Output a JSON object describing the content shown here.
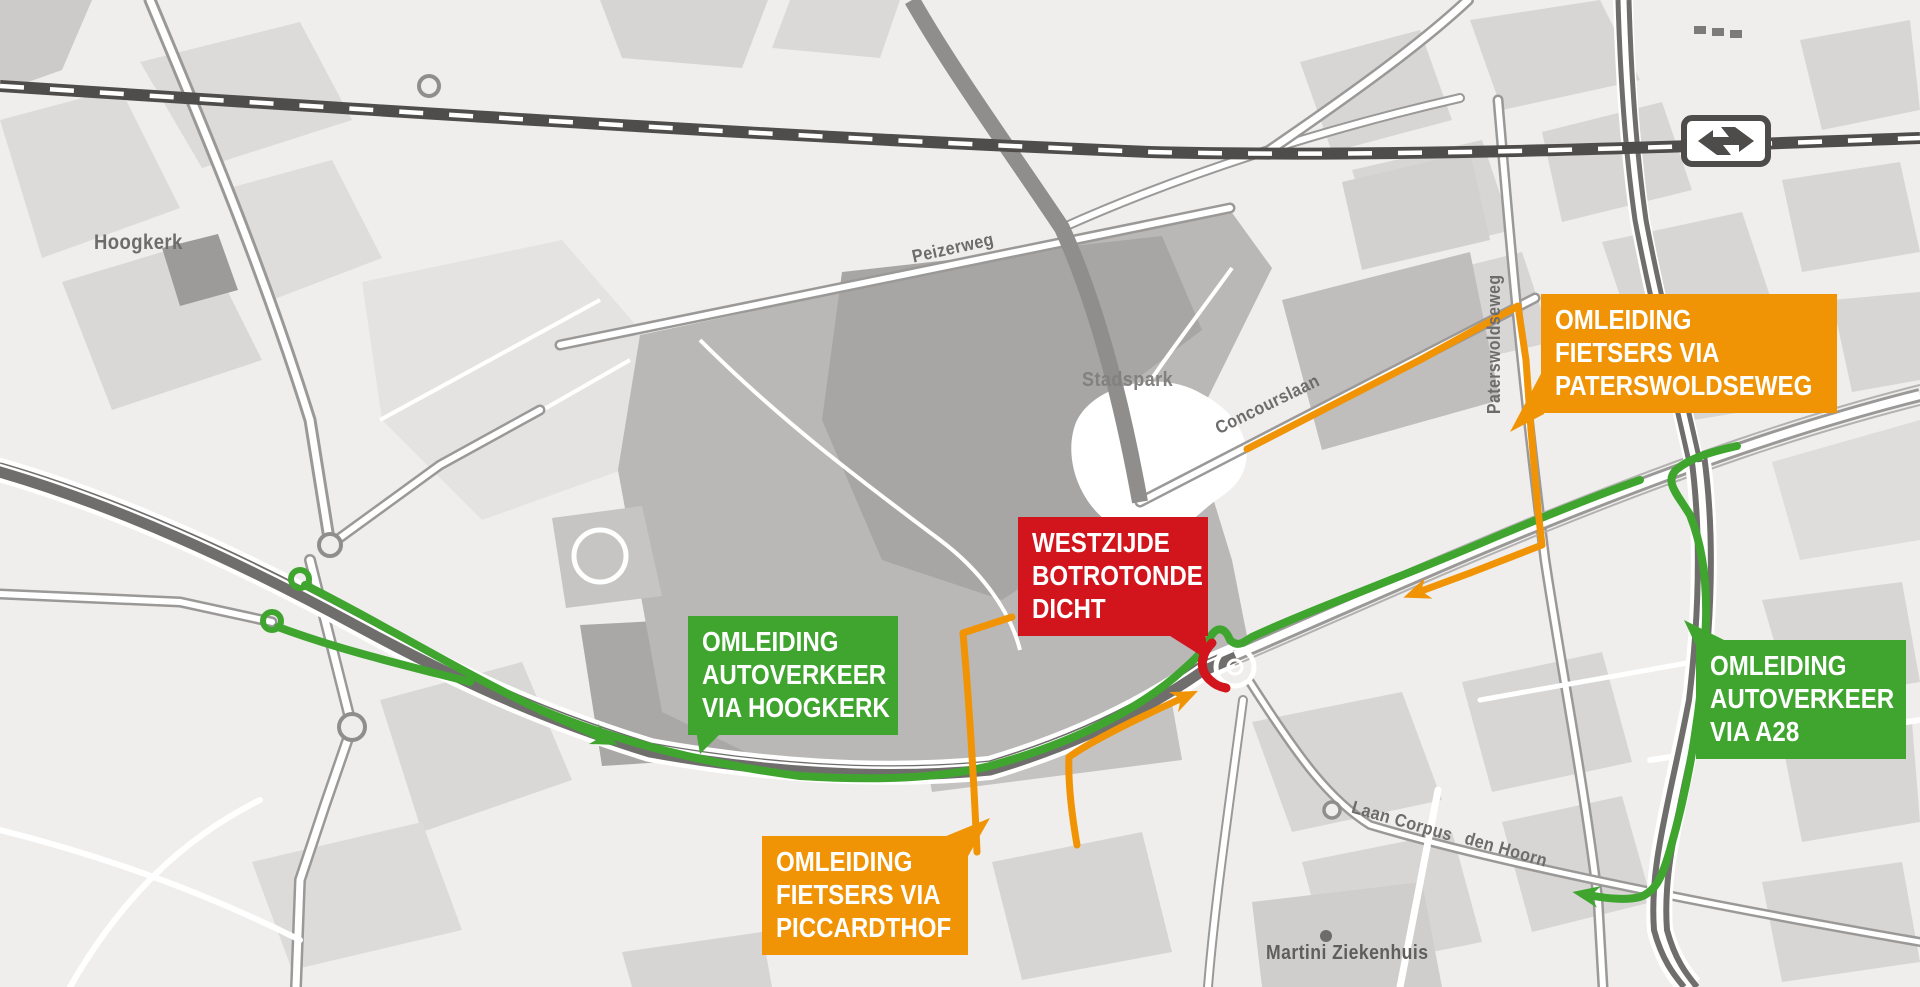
{
  "colors": {
    "detour_car_green": "#3FA52F",
    "detour_bike_orange": "#F09405",
    "closure_red": "#D2151C",
    "railway_dark": "#4E4D4C",
    "motorway_gray": "#6F6E6D",
    "map_background": "#EFEEEC"
  },
  "icons": {
    "railway_logo": "ns-double-arrow-icon"
  },
  "places": {
    "hoogkerk": "Hoogkerk",
    "peizerweg": "Peizerweg",
    "stadspark": "Stadspark",
    "concourslaan": "Concourslaan",
    "paterswoldseweg": "Paterswoldseweg",
    "laan_corpus": "Laan Corpus",
    "den_hoorn": "den Hoorn",
    "martini_ziekenhuis": "Martini Ziekenhuis"
  },
  "callouts": {
    "fietsers_paterswoldseweg": {
      "color": "#F09405",
      "lines": [
        "OMLEIDING",
        "FIETSERS VIA",
        "PATERSWOLDSEWEG"
      ]
    },
    "westzijde_botrotonde": {
      "color": "#D2151C",
      "lines": [
        "WESTZIJDE",
        "BOTROTONDE",
        "DICHT"
      ]
    },
    "autoverkeer_hoogkerk": {
      "color": "#3FA52F",
      "lines": [
        "OMLEIDING",
        "AUTOVERKEER",
        "VIA HOOGKERK"
      ]
    },
    "fietsers_piccardthof": {
      "color": "#F09405",
      "lines": [
        "OMLEIDING",
        "FIETSERS VIA",
        "PICCARDTHOF"
      ]
    },
    "autoverkeer_a28": {
      "color": "#3FA52F",
      "lines": [
        "OMLEIDING",
        "AUTOVERKEER",
        "VIA A28"
      ]
    }
  }
}
